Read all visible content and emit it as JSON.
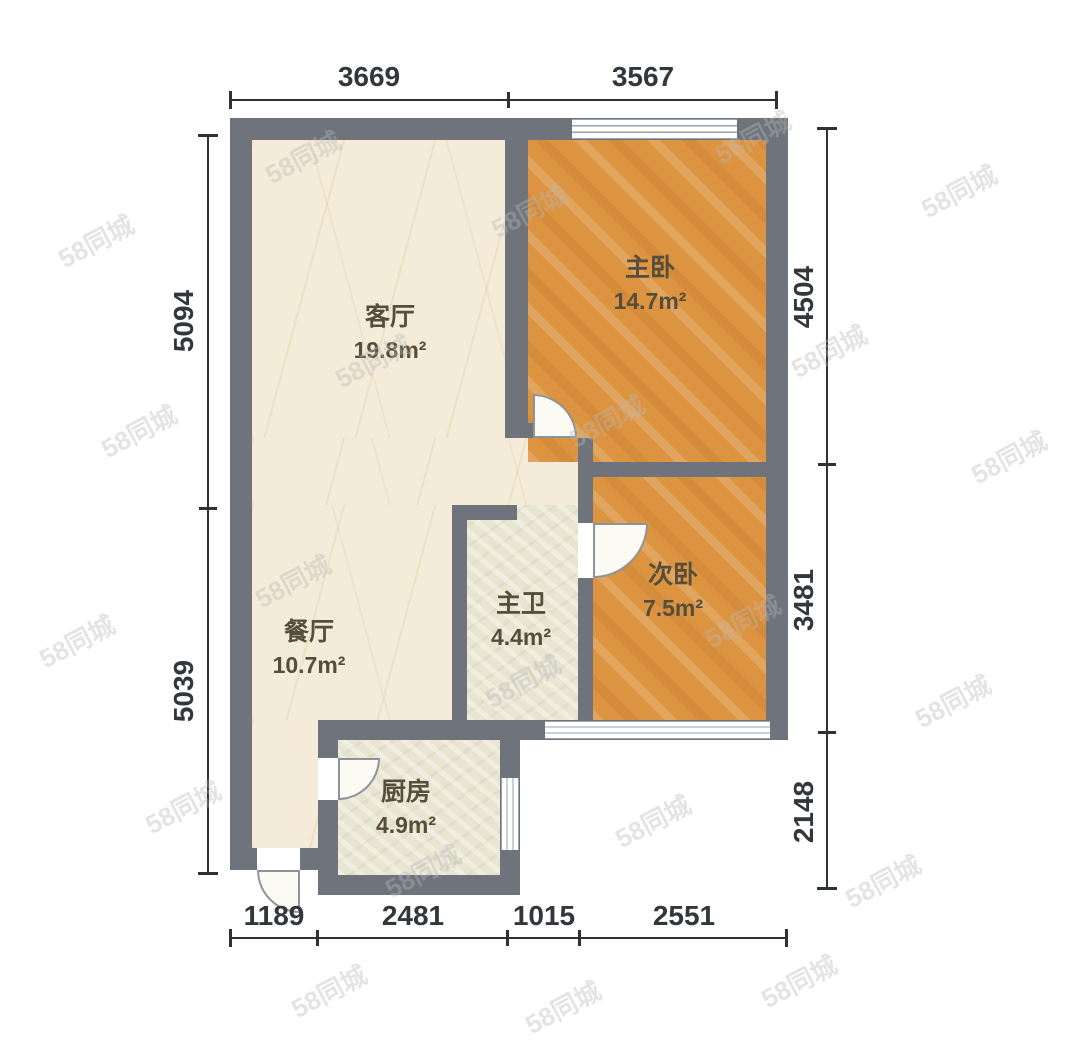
{
  "watermark": {
    "text": "58同城"
  },
  "rooms": [
    {
      "id": "living",
      "name": "客厅",
      "area": "19.8m²"
    },
    {
      "id": "master-bedroom",
      "name": "主卧",
      "area": "14.7m²"
    },
    {
      "id": "second-bedroom",
      "name": "次卧",
      "area": "7.5m²"
    },
    {
      "id": "dining",
      "name": "餐厅",
      "area": "10.7m²"
    },
    {
      "id": "master-bath",
      "name": "主卫",
      "area": "4.4m²"
    },
    {
      "id": "kitchen",
      "name": "厨房",
      "area": "4.9m²"
    }
  ],
  "dimensions": {
    "top": [
      "3669",
      "3567"
    ],
    "bottom": [
      "1189",
      "2481",
      "1015",
      "2551"
    ],
    "left": [
      "5094",
      "5039"
    ],
    "right": [
      "4504",
      "3481",
      "2148"
    ]
  },
  "colors": {
    "wall": "#6e737c",
    "wood_floor": "#dd9440",
    "tile_floor": "#f4ebd8",
    "wet_floor": "#e8e5d0"
  }
}
